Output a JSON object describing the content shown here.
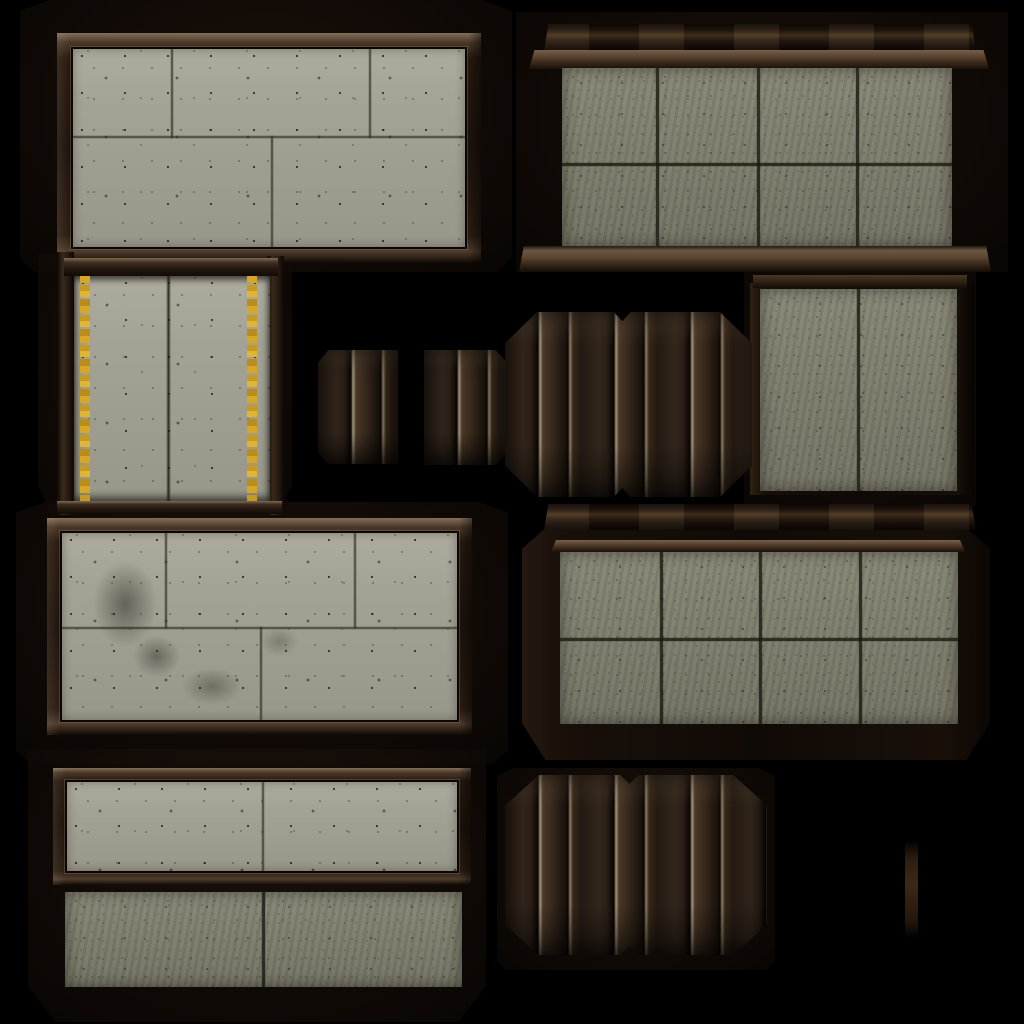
{
  "meta": {
    "description": "Game texture atlas: framed concrete wall panels, cornice-topped concrete slabs, dark wood plank panels and a hazard-striped column on a black background",
    "canvas": {
      "width": 1024,
      "height": 1024,
      "background": "#000000"
    }
  },
  "palette": {
    "background": "#000000",
    "concrete-light": "#a4a294",
    "concrete-olive": "#807f6e",
    "grout": "#302e21",
    "wood-dark": "#1a110b",
    "wood-mid": "#2e2118",
    "wood-light": "#6f5d4a",
    "wood-highlight": "#a4957e",
    "stripe-gold": "#d7a624",
    "shadow-brown": "#150d08"
  },
  "atlas": {
    "tiles": [
      {
        "id": "bk-top-left",
        "name": "shadow-backing-top-left",
        "material": "shadow",
        "x": 20,
        "y": 0,
        "w": 492,
        "h": 272
      },
      {
        "id": "bk-top-right",
        "name": "shadow-backing-top-right",
        "material": "shadow",
        "x": 516,
        "y": 12,
        "w": 492,
        "h": 260
      },
      {
        "id": "bk-mid-left",
        "name": "shadow-backing-mid-left",
        "material": "shadow",
        "x": 38,
        "y": 250,
        "w": 254,
        "h": 270
      },
      {
        "id": "bk-mid-right",
        "name": "shadow-backing-mid-right",
        "material": "shadow",
        "x": 744,
        "y": 262,
        "w": 232,
        "h": 244
      },
      {
        "id": "bk-center-left",
        "name": "shadow-backing-center-left",
        "material": "shadow",
        "x": 16,
        "y": 502,
        "w": 492,
        "h": 262
      },
      {
        "id": "bk-bottom-left",
        "name": "shadow-backing-bottom-left",
        "material": "shadow",
        "x": 28,
        "y": 746,
        "w": 458,
        "h": 276
      },
      {
        "id": "bk-bottom-mid",
        "name": "shadow-backing-bottom-mid",
        "material": "shadow",
        "x": 497,
        "y": 768,
        "w": 278,
        "h": 202
      },
      {
        "id": "p1-frame",
        "name": "framed-concrete-panel-top-left",
        "material": "wood-frame+concrete-light",
        "x": 57,
        "y": 33,
        "w": 424,
        "h": 230
      },
      {
        "id": "tr-cap",
        "name": "cornice-cap-top-right",
        "material": "wood-molding",
        "x": 544,
        "y": 24,
        "w": 432,
        "h": 28
      },
      {
        "id": "tr-ledge",
        "name": "cornice-ledge-top-right",
        "material": "wood-molding",
        "x": 529,
        "y": 50,
        "w": 460,
        "h": 19
      },
      {
        "id": "tr-concrete",
        "name": "tiled-concrete-top-right",
        "material": "concrete-olive",
        "x": 562,
        "y": 68,
        "w": 390,
        "h": 179
      },
      {
        "id": "tr-sill",
        "name": "sill-top-right",
        "material": "wood-molding",
        "x": 519,
        "y": 246,
        "w": 472,
        "h": 26
      },
      {
        "id": "mr-subsill",
        "name": "subsill-mid-right",
        "material": "wood-molding",
        "x": 753,
        "y": 275,
        "w": 214,
        "h": 13
      },
      {
        "id": "mr-frame",
        "name": "column-frame-mid-right",
        "material": "wood-frame",
        "x": 750,
        "y": 283,
        "w": 224,
        "h": 212
      },
      {
        "id": "mr-concrete",
        "name": "concrete-column-mid-right",
        "material": "concrete-olive",
        "x": 760,
        "y": 289,
        "w": 197,
        "h": 202
      },
      {
        "id": "ml-post-left",
        "name": "post-left-striped-panel",
        "material": "wood-frame",
        "x": 57,
        "y": 252,
        "w": 17,
        "h": 263
      },
      {
        "id": "ml-post-right",
        "name": "post-right-striped-panel",
        "material": "wood-frame",
        "x": 267,
        "y": 256,
        "w": 17,
        "h": 259
      },
      {
        "id": "ml-rail-top",
        "name": "rail-top-striped-panel",
        "material": "wood-molding",
        "x": 64,
        "y": 258,
        "w": 214,
        "h": 18
      },
      {
        "id": "ml-concrete",
        "name": "hazard-striped-concrete-panel",
        "material": "concrete-light+gold-stripes",
        "x": 74,
        "y": 276,
        "w": 196,
        "h": 227
      },
      {
        "id": "ml-rail-bottom",
        "name": "rail-bottom-striped-panel",
        "material": "wood-molding",
        "x": 57,
        "y": 501,
        "w": 225,
        "h": 13
      },
      {
        "id": "strip-a",
        "name": "plank-strip-left",
        "material": "wood-planks",
        "x": 318,
        "y": 350,
        "w": 80,
        "h": 114
      },
      {
        "id": "strip-b",
        "name": "plank-strip-right",
        "material": "wood-planks",
        "x": 424,
        "y": 350,
        "w": 83,
        "h": 115
      },
      {
        "id": "oct-center",
        "name": "octagonal-plank-panel-center",
        "material": "wood-planks",
        "x": 505,
        "y": 312,
        "w": 247,
        "h": 185
      },
      {
        "id": "p7-frame",
        "name": "framed-concrete-panel-center-left",
        "material": "wood-frame+concrete-light",
        "x": 47,
        "y": 518,
        "w": 425,
        "h": 217
      },
      {
        "id": "cr-backing",
        "name": "slab-backing-center-right",
        "material": "wood-frame",
        "x": 522,
        "y": 528,
        "w": 468,
        "h": 232
      },
      {
        "id": "cr-cap",
        "name": "cornice-cap-center-right",
        "material": "wood-molding",
        "x": 544,
        "y": 504,
        "w": 432,
        "h": 26
      },
      {
        "id": "cr-ledge",
        "name": "cornice-ledge-center-right",
        "material": "wood-molding",
        "x": 551,
        "y": 540,
        "w": 414,
        "h": 12
      },
      {
        "id": "cr-concrete",
        "name": "tiled-concrete-center-right",
        "material": "concrete-olive",
        "x": 560,
        "y": 552,
        "w": 398,
        "h": 172
      },
      {
        "id": "b1-frame",
        "name": "framed-concrete-bar-bottom",
        "material": "wood-frame+concrete-light",
        "x": 53,
        "y": 768,
        "w": 418,
        "h": 117
      },
      {
        "id": "b2-concrete",
        "name": "concrete-bar-bottom-olive",
        "material": "concrete-olive",
        "x": 65,
        "y": 892,
        "w": 397,
        "h": 95
      },
      {
        "id": "oct-bottom",
        "name": "octagonal-plank-panel-bottom",
        "material": "wood-planks",
        "x": 505,
        "y": 775,
        "w": 262,
        "h": 180
      },
      {
        "id": "right-strip",
        "name": "thin-wood-strip-right-edge",
        "material": "wood-planks",
        "x": 905,
        "y": 840,
        "w": 13,
        "h": 98
      }
    ]
  }
}
